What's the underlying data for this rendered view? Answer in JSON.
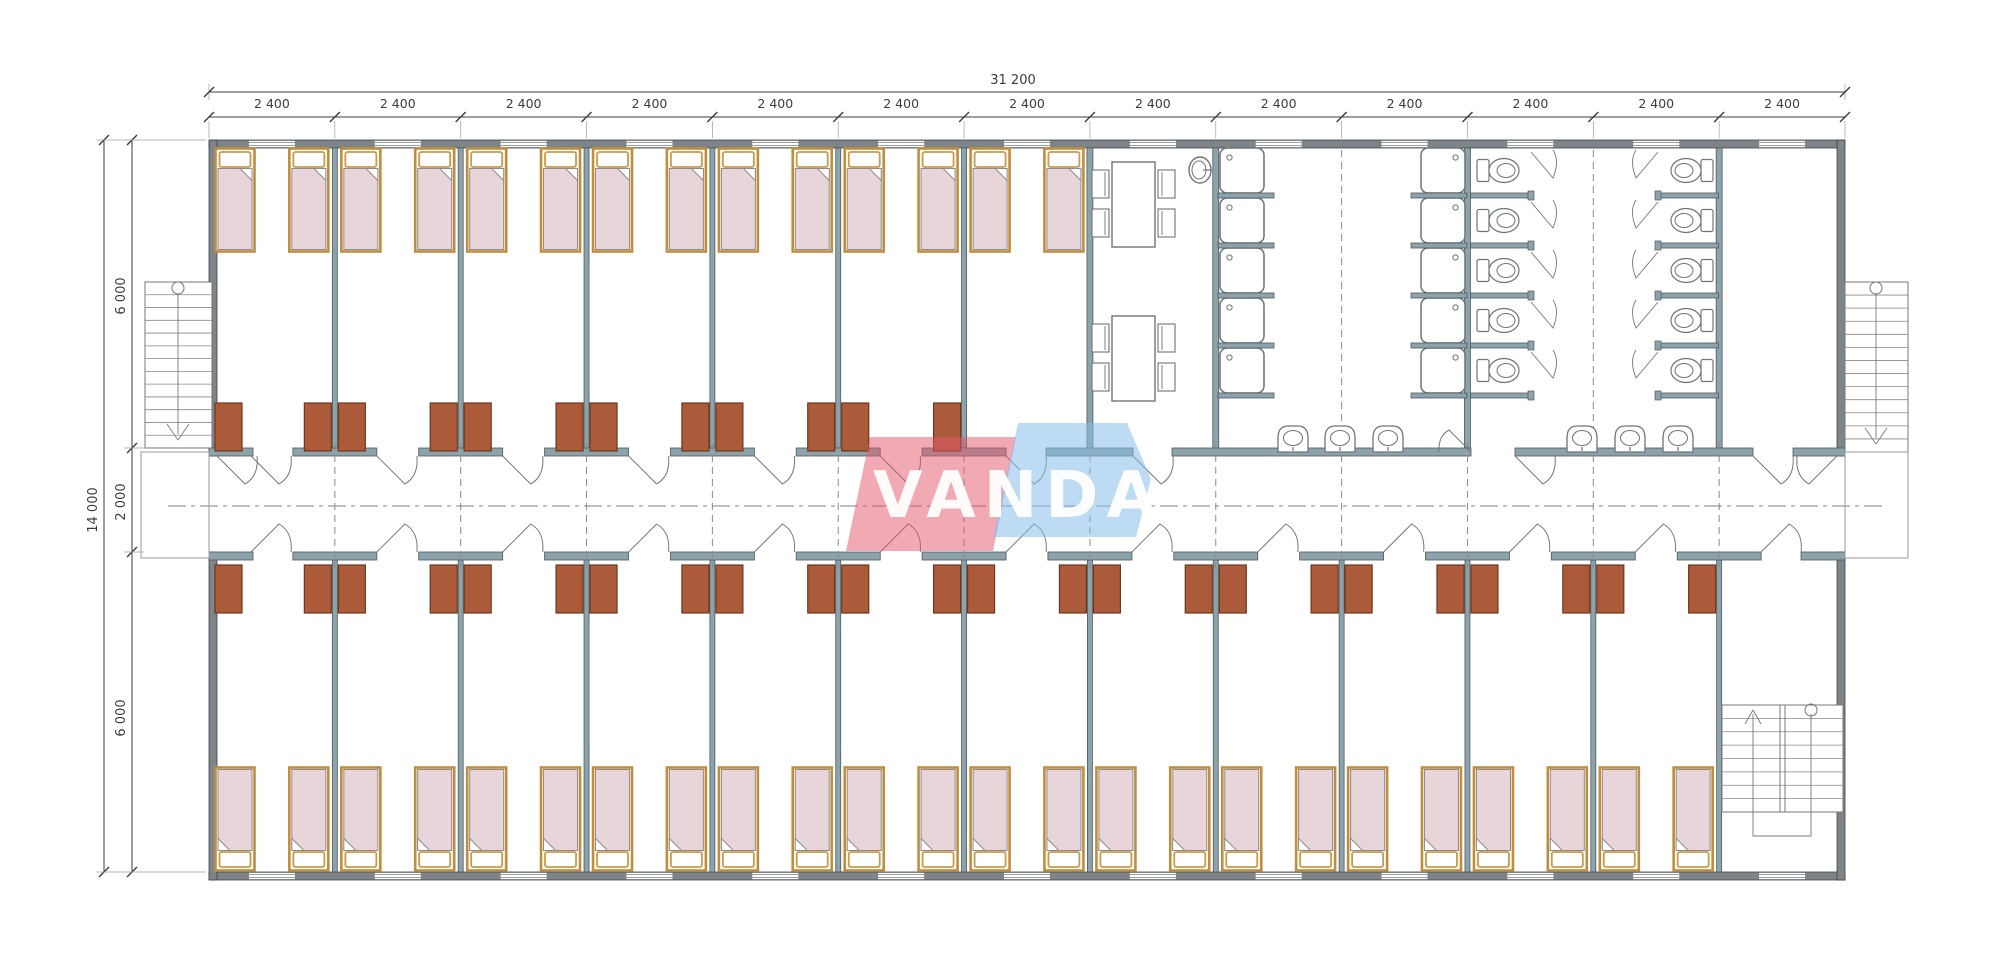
{
  "watermark": {
    "text": "VANDA",
    "red_color": "#e4556a",
    "blue_color": "#86bde8"
  },
  "dimensions": {
    "top_total": {
      "label": "31 200"
    },
    "top_bays": {
      "label": "2 400",
      "count": 13
    },
    "left_total": {
      "label": "14 000"
    },
    "left_upper": {
      "label": "6 000"
    },
    "left_corridor": {
      "label": "2 000"
    },
    "left_lower": {
      "label": "6 000"
    }
  },
  "colors": {
    "exterior_wall": "#7e8487",
    "wall_edge": "#3f4447",
    "partition_wall": "#8ca3ab",
    "partition_edge": "#50595d",
    "wardrobe_fill": "#ac5b3a",
    "wardrobe_edge": "#6d371e",
    "bed_frame": "#c08d3c",
    "bed_pillow_edge": "#c99a4a",
    "bed_blanket": "#e7d5da",
    "blanket_edge": "#908a8a",
    "fixture_line": "#6f7478",
    "dimension_line": "#3c3c3c",
    "centerline": "#808080",
    "axis_dash": "#8a8a8a"
  },
  "inventory": {
    "bedrooms_top": 7,
    "bedrooms_bottom": 12,
    "beds_per_room": 2,
    "shower_stalls": 10,
    "toilet_stalls": 10,
    "wash_basins": 6,
    "dining_tables": 2,
    "chairs_per_table": 4,
    "external_stairs": 2,
    "internal_stairs": 1
  }
}
